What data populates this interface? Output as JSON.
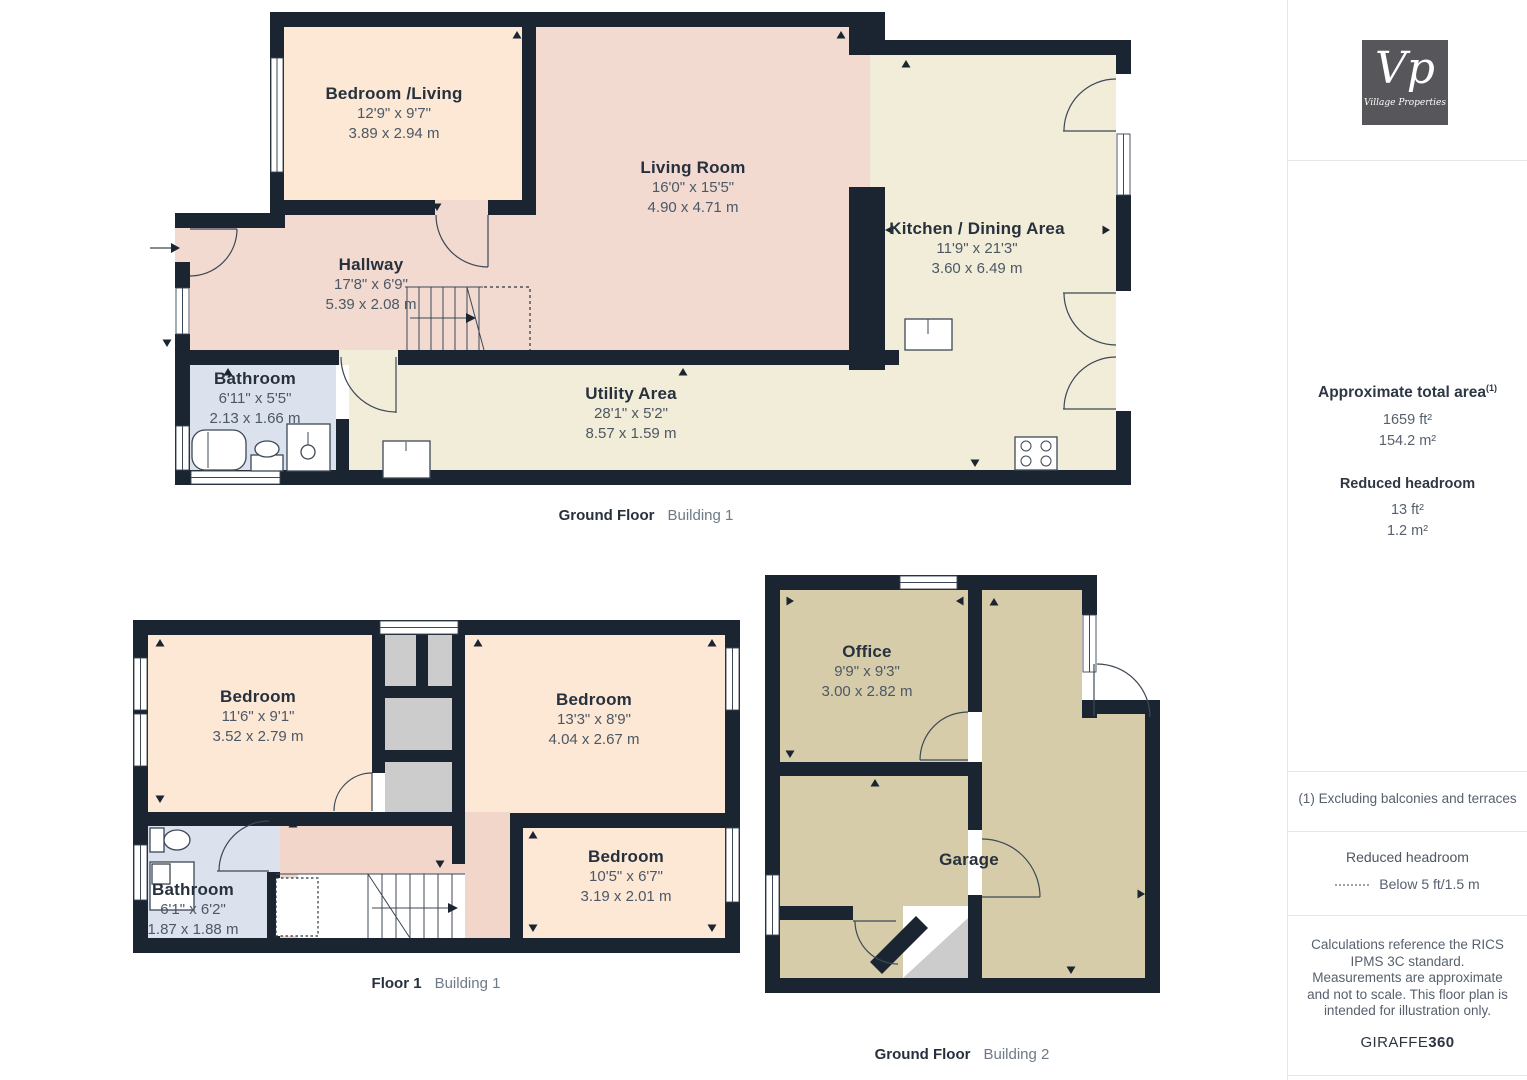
{
  "brand": {
    "logo_short": "Vp",
    "logo_name": "Village Properties"
  },
  "sidebar": {
    "total_area_label": "Approximate total area",
    "total_area_sup": "(1)",
    "total_area_ft": "1659 ft²",
    "total_area_m": "154.2 m²",
    "reduced_headroom_label": "Reduced headroom",
    "reduced_headroom_ft": "13 ft²",
    "reduced_headroom_m": "1.2 m²",
    "footnote": "(1) Excluding balconies and terraces",
    "legend_title": "Reduced headroom",
    "legend_value": "Below 5 ft/1.5 m",
    "disclaimer": "Calculations reference the RICS IPMS 3C standard. Measurements are approximate and not to scale. This floor plan is intended for illustration only.",
    "brand_footer_regular": "GIRAFFE",
    "brand_footer_bold": "360"
  },
  "plans": [
    {
      "caption": "Ground Floor",
      "building": "Building 1",
      "rooms": [
        {
          "name": "Bedroom /Living",
          "imperial": "12'9\" x 9'7\"",
          "metric": "3.89 x 2.94 m"
        },
        {
          "name": "Living Room",
          "imperial": "16'0\" x 15'5\"",
          "metric": "4.90 x 4.71 m"
        },
        {
          "name": "Kitchen / Dining Area",
          "imperial": "11'9\" x 21'3\"",
          "metric": "3.60 x 6.49 m"
        },
        {
          "name": "Hallway",
          "imperial": "17'8\" x 6'9\"",
          "metric": "5.39 x 2.08 m"
        },
        {
          "name": "Bathroom",
          "imperial": "6'11\" x 5'5\"",
          "metric": "2.13 x 1.66 m"
        },
        {
          "name": "Utility Area",
          "imperial": "28'1\" x 5'2\"",
          "metric": "8.57 x 1.59 m"
        }
      ]
    },
    {
      "caption": "Floor 1",
      "building": "Building 1",
      "rooms": [
        {
          "name": "Bedroom",
          "imperial": "11'6\" x 9'1\"",
          "metric": "3.52 x 2.79 m"
        },
        {
          "name": "Bedroom",
          "imperial": "13'3\" x 8'9\"",
          "metric": "4.04 x 2.67 m"
        },
        {
          "name": "Bedroom",
          "imperial": "10'5\" x 6'7\"",
          "metric": "3.19 x 2.01 m"
        },
        {
          "name": "Bathroom",
          "imperial": "6'1\" x 6'2\"",
          "metric": "1.87 x 1.88 m"
        }
      ]
    },
    {
      "caption": "Ground Floor",
      "building": "Building 2",
      "rooms": [
        {
          "name": "Office",
          "imperial": "9'9\" x 9'3\"",
          "metric": "3.00 x 2.82 m"
        },
        {
          "name": "Garage",
          "imperial": "",
          "metric": ""
        }
      ]
    }
  ],
  "colors": {
    "wall": "#1b2531",
    "room_peach": "#fce8d5",
    "room_pink": "#f2dad1",
    "landing_pink": "#f1d6c9",
    "room_cream": "#f2edd9",
    "room_blue": "#dce1ee",
    "room_tan": "#d6cca9",
    "room_gray": "#cbcccb",
    "label_dark": "#27313d",
    "label_gray": "#4c5866",
    "caption_gray": "#6e7a88",
    "logo_bg": "#56565b",
    "divider": "#e4e6ea"
  }
}
